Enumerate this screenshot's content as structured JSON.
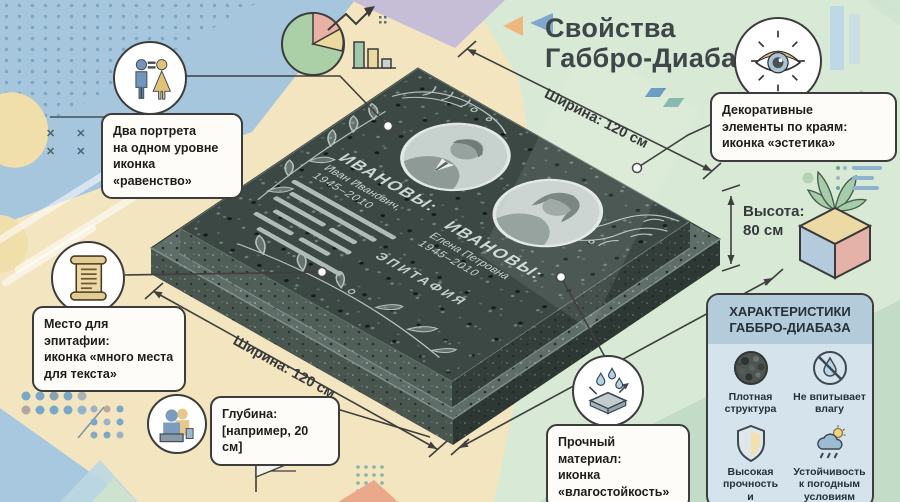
{
  "title": {
    "text": "Свойства\nГаббро-Диабаз"
  },
  "dimensions": {
    "width_top": "Ширина: 120 см",
    "width_bottom": "Ширина: 120 см",
    "height": "Высота:\n80 см"
  },
  "callouts": {
    "portraits": "Два портрета\nна одном уровне\nиконка «равенство»",
    "decor": "Декоративные\nэлементы по краям:\nиконка «эстетика»",
    "epitaph": "Место для эпитафии:\nиконка «много места\nдля текста»",
    "depth": "Глубина:\n[например, 20 см]",
    "material": "Прочный материал:\nиконка\n«влагостойкость»"
  },
  "monument": {
    "left_person": {
      "family": "ИВАНОВЫ:",
      "name": "Иван Иванович,",
      "years": "1945–2010"
    },
    "right_person": {
      "family": "ИВАНОВЫ:",
      "name": "Елена Петровна",
      "years": "1945–2010"
    },
    "epitaph_label": "ЭПИТАФИЯ"
  },
  "panel": {
    "title": "ХАРАКТЕРИСТИКИ\nГАББРО-ДИАБАЗА",
    "items": [
      {
        "icon": "dense-structure-icon",
        "label": "Плотная\nструктура"
      },
      {
        "icon": "no-moisture-icon",
        "label": "Не впитывает\nвлагу"
      },
      {
        "icon": "shield-icon",
        "label": "Высокая\nпрочность\nи долговечность"
      },
      {
        "icon": "weather-icon",
        "label": "Устойчивость\nк погодным\nусловиям"
      }
    ]
  },
  "icons": {
    "portraits": "man-woman-equals-icon",
    "decor": "eye-icon",
    "epitaph": "scroll-icon",
    "depth": "podium-people-icon",
    "material": "water-drops-icon"
  },
  "colors": {
    "background_blue": "#a5c6dc",
    "background_beige": "#f3e5c0",
    "background_green": "#d8e9d5",
    "stone_top": "#3b4843",
    "engraving": "#c6d1cd",
    "panel_body": "#d4e3ec",
    "callout_border": "#3c3c3c"
  }
}
